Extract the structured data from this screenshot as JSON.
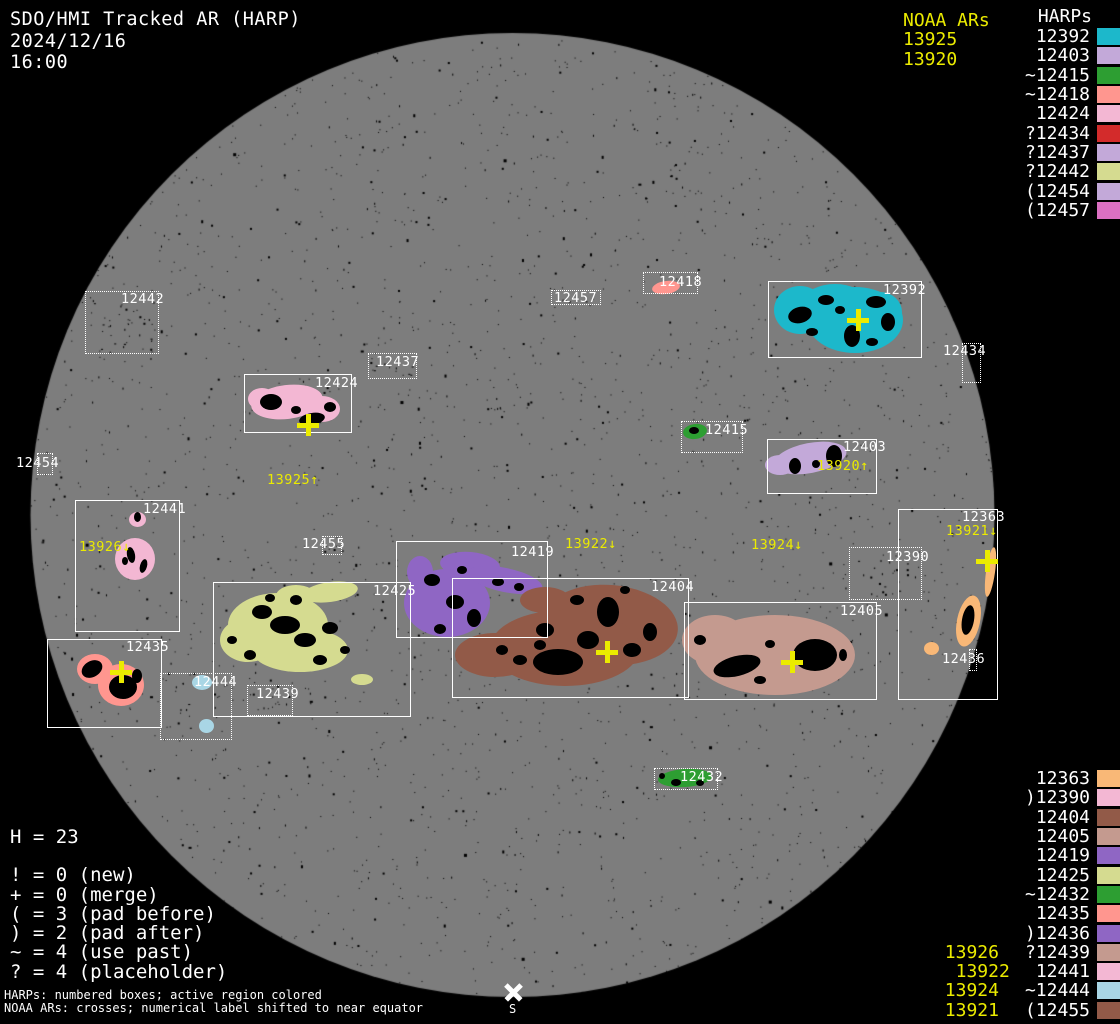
{
  "header": {
    "title": "SDO/HMI Tracked AR (HARP)",
    "date": "2024/12/16",
    "time": "16:00"
  },
  "colors": {
    "background": "#000000",
    "disk": "#7d7d7d",
    "text": "#ffffff",
    "noaa_yellow": "#ebeb00",
    "cyan": "#1cb8cb",
    "lavender": "#c3a9d9",
    "green": "#2d9e32",
    "salmon": "#ff968f",
    "pink": "#f3b7d3",
    "red": "#d32b2b",
    "khaki": "#d5db90",
    "orchid": "#db70c2",
    "orange": "#f9b877",
    "brown": "#925a48",
    "rosy": "#c49a8f",
    "purple": "#8f66c4",
    "lightblue": "#a9d6e5"
  },
  "legend_top_right": {
    "noaa_title": "NOAA ARs",
    "noaa_items": [
      "13925",
      "13920"
    ],
    "harps_title": "HARPs",
    "items": [
      {
        "label": "12392",
        "color": "#1cb8cb"
      },
      {
        "label": "12403",
        "color": "#c3a9d9"
      },
      {
        "label": "~12415",
        "color": "#2d9e32"
      },
      {
        "label": "~12418",
        "color": "#ff968f"
      },
      {
        "label": "12424",
        "color": "#f3b7d3"
      },
      {
        "label": "?12434",
        "color": "#d32b2b"
      },
      {
        "label": "?12437",
        "color": "#c3a9d9"
      },
      {
        "label": "?12442",
        "color": "#d5db90"
      },
      {
        "label": "(12454",
        "color": "#c3a9d9"
      },
      {
        "label": "(12457",
        "color": "#db70c2"
      }
    ]
  },
  "legend_bottom_right": {
    "items": [
      {
        "label": "12363",
        "color": "#f9b877",
        "noaa": ""
      },
      {
        "label": ")12390",
        "color": "#f3b7d3",
        "noaa": ""
      },
      {
        "label": "12404",
        "color": "#925a48",
        "noaa": ""
      },
      {
        "label": "12405",
        "color": "#c49a8f",
        "noaa": ""
      },
      {
        "label": "12419",
        "color": "#8f66c4",
        "noaa": ""
      },
      {
        "label": "12425",
        "color": "#d5db90",
        "noaa": ""
      },
      {
        "label": "~12432",
        "color": "#2d9e32",
        "noaa": ""
      },
      {
        "label": "12435",
        "color": "#ff968f",
        "noaa": ""
      },
      {
        "label": ")12436",
        "color": "#8f66c4",
        "noaa": ""
      },
      {
        "label": "?12439",
        "color": "#c49a8f",
        "noaa": "13926"
      },
      {
        "label": "12441",
        "color": "#f3b7d3",
        "noaa": "13922"
      },
      {
        "label": "~12444",
        "color": "#a9d6e5",
        "noaa": "13924"
      },
      {
        "label": "(12455",
        "color": "#925a48",
        "noaa": "13921"
      }
    ]
  },
  "stats": {
    "h_line": "H = 23",
    "lines": [
      "! = 0 (new)",
      "+ = 0 (merge)",
      "( = 3 (pad before)",
      ") = 2 (pad after)",
      "~ = 4 (use past)",
      "? = 4 (placeholder)"
    ]
  },
  "footer": {
    "line1": "HARPs: numbered boxes; active region colored",
    "line2": "NOAA ARs: crosses; numerical label shifted to near equator"
  },
  "south": {
    "label": "S"
  },
  "noaa_map_labels": [
    {
      "text": "13925↑",
      "xy": [
        267,
        474
      ]
    },
    {
      "text": "13920↑",
      "xy": [
        817,
        460
      ]
    },
    {
      "text": "13926↓",
      "xy": [
        79,
        541
      ]
    },
    {
      "text": "13922↓",
      "xy": [
        565,
        538
      ]
    },
    {
      "text": "13924↓",
      "xy": [
        751,
        539
      ]
    },
    {
      "text": "13921↓",
      "xy": [
        946,
        525
      ]
    }
  ],
  "regions": [
    {
      "id": "12442",
      "label": "12442",
      "box": [
        85,
        291,
        74,
        63
      ],
      "style": "dotted",
      "label_xy": [
        121,
        293
      ],
      "specks": 28
    },
    {
      "id": "12457",
      "label": "12457",
      "box": [
        551,
        290,
        50,
        15
      ],
      "style": "dotted",
      "label_xy": [
        554,
        292
      ],
      "specks": 6
    },
    {
      "id": "12418",
      "label": "12418",
      "box": [
        643,
        272,
        55,
        22
      ],
      "style": "dotted",
      "label_xy": [
        659,
        276
      ],
      "color": "#ff968f",
      "blobs": [
        [
          666,
          287,
          14,
          6.5,
          -8
        ]
      ]
    },
    {
      "id": "12392",
      "label": "12392",
      "box": [
        768,
        281,
        154,
        77
      ],
      "style": "solid",
      "label_xy": [
        883,
        284
      ],
      "color": "#1cb8cb",
      "blobs": [
        [
          800,
          310,
          26,
          24,
          0
        ],
        [
          855,
          320,
          48,
          33,
          0
        ],
        [
          835,
          300,
          30,
          16,
          0
        ],
        [
          880,
          312,
          22,
          20,
          0
        ]
      ],
      "spots": [
        [
          852,
          336,
          8,
          11,
          0
        ],
        [
          800,
          315,
          12,
          8,
          -15
        ],
        [
          826,
          300,
          8,
          5,
          0
        ],
        [
          876,
          302,
          10,
          6,
          0
        ],
        [
          888,
          322,
          7,
          9,
          0
        ],
        [
          812,
          332,
          6,
          4,
          0
        ],
        [
          872,
          342,
          6,
          4,
          0
        ],
        [
          840,
          310,
          5,
          4,
          0
        ]
      ],
      "cross": [
        858,
        320
      ]
    },
    {
      "id": "12434",
      "label": "12434",
      "box": [
        962,
        343,
        19,
        40
      ],
      "style": "dotted",
      "label_xy": [
        943,
        345
      ]
    },
    {
      "id": "12437",
      "label": "12437",
      "box": [
        368,
        353,
        49,
        26
      ],
      "style": "dotted",
      "label_xy": [
        376,
        356
      ],
      "specks": 12
    },
    {
      "id": "12424",
      "label": "12424",
      "box": [
        244,
        374,
        108,
        59
      ],
      "style": "solid",
      "label_xy": [
        315,
        377
      ],
      "color": "#f3b7d3",
      "blobs": [
        [
          287,
          402,
          36,
          17,
          -7
        ],
        [
          322,
          409,
          18,
          13,
          0
        ],
        [
          262,
          399,
          14,
          11,
          0
        ]
      ],
      "spots": [
        [
          271,
          402,
          11,
          8,
          0
        ],
        [
          312,
          419,
          13,
          6,
          -10
        ],
        [
          330,
          407,
          6,
          5,
          0
        ],
        [
          296,
          410,
          5,
          4,
          0
        ]
      ],
      "cross": [
        308,
        425
      ]
    },
    {
      "id": "12415",
      "label": "12415",
      "box": [
        681,
        421,
        62,
        32
      ],
      "style": "dotted",
      "label_xy": [
        705,
        424
      ],
      "color": "#2d9e32",
      "blobs": [
        [
          695,
          431,
          12,
          7.5,
          -8
        ]
      ],
      "spots": [
        [
          694,
          430,
          5,
          3.5,
          0
        ]
      ]
    },
    {
      "id": "12403",
      "label": "12403",
      "box": [
        767,
        439,
        110,
        55
      ],
      "style": "solid",
      "label_xy": [
        843,
        441
      ],
      "color": "#c3a9d9",
      "blobs": [
        [
          810,
          458,
          37,
          15,
          -11
        ],
        [
          780,
          465,
          15,
          10,
          0
        ]
      ],
      "spots": [
        [
          834,
          456,
          8,
          11,
          0
        ],
        [
          795,
          466,
          6,
          8,
          0
        ],
        [
          816,
          464,
          4,
          4,
          0
        ]
      ]
    },
    {
      "id": "12454",
      "label": "12454",
      "box": [
        37,
        453,
        16,
        22
      ],
      "style": "dotted",
      "label_xy": [
        16,
        457
      ]
    },
    {
      "id": "12441",
      "label": "12441",
      "box": [
        75,
        500,
        105,
        132
      ],
      "style": "solid",
      "label_xy": [
        143,
        503
      ],
      "color": "#f3b7d3",
      "blobs": [
        [
          137,
          519,
          8.5,
          7.5,
          0
        ],
        [
          135,
          559,
          20,
          21,
          0
        ]
      ],
      "spots": [
        [
          137,
          517,
          3.5,
          5,
          0
        ],
        [
          131,
          555,
          4,
          8,
          -10
        ],
        [
          143,
          566,
          3.5,
          7,
          15
        ],
        [
          125,
          561,
          3,
          4,
          0
        ]
      ]
    },
    {
      "id": "12455",
      "label": "12455",
      "box": [
        322,
        536,
        20,
        19
      ],
      "style": "dotted",
      "label_xy": [
        302,
        538
      ],
      "specks": 5
    },
    {
      "id": "12419",
      "label": "12419",
      "box": [
        396,
        541,
        152,
        97
      ],
      "style": "solid",
      "label_xy": [
        511,
        546
      ],
      "color": "#8f66c4",
      "blobs": [
        [
          470,
          565,
          30,
          13,
          5
        ],
        [
          447,
          603,
          43,
          34,
          0
        ],
        [
          505,
          580,
          38,
          12,
          12
        ],
        [
          420,
          572,
          13,
          16,
          0
        ]
      ],
      "spots": [
        [
          432,
          580,
          8,
          6,
          0
        ],
        [
          455,
          602,
          9,
          7,
          0
        ],
        [
          474,
          618,
          7,
          9,
          0
        ],
        [
          440,
          629,
          6,
          5,
          0
        ],
        [
          498,
          582,
          6,
          4,
          0
        ],
        [
          519,
          587,
          5,
          4,
          0
        ],
        [
          462,
          570,
          5,
          4,
          0
        ]
      ]
    },
    {
      "id": "12390",
      "label": "12390",
      "box": [
        849,
        547,
        73,
        53
      ],
      "style": "dotted",
      "label_xy": [
        886,
        551
      ],
      "specks": 20
    },
    {
      "id": "12363",
      "label": "12363",
      "box": [
        898,
        509,
        100,
        191
      ],
      "style": "solid",
      "label_xy": [
        962,
        511
      ],
      "color": "#f9b877",
      "blobs": [
        [
          990,
          572,
          4.5,
          25,
          8
        ],
        [
          968,
          621,
          11.5,
          26,
          12
        ],
        [
          931,
          648,
          7.5,
          6.5,
          0
        ]
      ],
      "spots": [
        [
          968,
          620,
          6,
          15,
          10
        ]
      ],
      "cross": [
        987,
        561
      ]
    },
    {
      "id": "12425",
      "label": "12425",
      "box": [
        213,
        582,
        198,
        135
      ],
      "style": "solid",
      "label_xy": [
        373,
        585
      ],
      "color": "#d5db90",
      "blobs": [
        [
          330,
          592,
          28,
          10,
          -8
        ],
        [
          278,
          625,
          50,
          32,
          0
        ],
        [
          300,
          650,
          48,
          22,
          0
        ],
        [
          248,
          640,
          28,
          22,
          0
        ],
        [
          362,
          679,
          11,
          5.5,
          0
        ],
        [
          296,
          596,
          20,
          11,
          0
        ]
      ],
      "spots": [
        [
          262,
          612,
          10,
          7,
          0
        ],
        [
          285,
          625,
          15,
          9,
          0
        ],
        [
          305,
          640,
          11,
          7,
          0
        ],
        [
          250,
          655,
          6,
          5,
          0
        ],
        [
          330,
          628,
          8,
          6,
          0
        ],
        [
          296,
          600,
          6,
          5,
          0
        ],
        [
          320,
          660,
          7,
          5,
          0
        ],
        [
          345,
          650,
          5,
          4,
          0
        ],
        [
          232,
          640,
          5,
          4,
          0
        ],
        [
          270,
          598,
          5,
          4,
          0
        ]
      ]
    },
    {
      "id": "12439",
      "label": "12439",
      "box": [
        247,
        685,
        46,
        31
      ],
      "style": "dotted",
      "label_xy": [
        256,
        688
      ],
      "specks": 10
    },
    {
      "id": "12444",
      "label": "12444",
      "box": [
        160,
        673,
        72,
        67
      ],
      "style": "dotted",
      "label_xy": [
        194,
        676
      ],
      "color": "#a9d6e5",
      "blobs": [
        [
          202,
          682,
          10,
          7.5,
          0
        ],
        [
          206,
          726,
          7.5,
          7,
          0
        ]
      ],
      "specks": 12
    },
    {
      "id": "12404",
      "label": "12404",
      "box": [
        452,
        578,
        237,
        120
      ],
      "style": "solid",
      "label_xy": [
        651,
        581
      ],
      "color": "#925a48",
      "blobs": [
        [
          610,
          625,
          68,
          40,
          5
        ],
        [
          565,
          648,
          75,
          38,
          0
        ],
        [
          495,
          655,
          40,
          22,
          0
        ],
        [
          545,
          600,
          25,
          13,
          0
        ]
      ],
      "spots": [
        [
          558,
          662,
          25,
          13,
          0
        ],
        [
          588,
          640,
          11,
          9,
          0
        ],
        [
          545,
          630,
          9,
          7,
          0
        ],
        [
          608,
          612,
          11,
          15,
          0
        ],
        [
          632,
          650,
          9,
          7,
          0
        ],
        [
          520,
          660,
          7,
          5,
          0
        ],
        [
          577,
          600,
          7,
          5,
          0
        ],
        [
          650,
          632,
          7,
          9,
          0
        ],
        [
          502,
          650,
          6,
          5,
          0
        ],
        [
          540,
          645,
          6,
          5,
          0
        ],
        [
          625,
          590,
          5,
          4,
          0
        ]
      ],
      "cross": [
        607,
        652
      ]
    },
    {
      "id": "12405",
      "label": "12405",
      "box": [
        684,
        602,
        193,
        98
      ],
      "style": "solid",
      "label_xy": [
        840,
        605
      ],
      "color": "#c49a8f",
      "blobs": [
        [
          775,
          655,
          80,
          40,
          0
        ],
        [
          715,
          640,
          33,
          25,
          0
        ]
      ],
      "spots": [
        [
          737,
          666,
          24,
          10,
          -14
        ],
        [
          815,
          655,
          22,
          16,
          0
        ],
        [
          700,
          640,
          6,
          5,
          0
        ],
        [
          770,
          644,
          5,
          4,
          0
        ],
        [
          843,
          655,
          4,
          6,
          0
        ],
        [
          760,
          680,
          6,
          4,
          0
        ]
      ],
      "cross": [
        792,
        662
      ]
    },
    {
      "id": "12435",
      "label": "12435",
      "box": [
        47,
        639,
        115,
        89
      ],
      "style": "solid",
      "label_xy": [
        126,
        641
      ],
      "color": "#ff968f",
      "blobs": [
        [
          95,
          669,
          18,
          15,
          0
        ],
        [
          121,
          685,
          23,
          21,
          0
        ]
      ],
      "spots": [
        [
          92,
          669,
          11,
          8,
          -30
        ],
        [
          123,
          687,
          14,
          12,
          0
        ],
        [
          137,
          676,
          5,
          7,
          0
        ]
      ],
      "cross": [
        121,
        672
      ]
    },
    {
      "id": "12436",
      "label": "12436",
      "box": [
        969,
        649,
        8,
        22
      ],
      "style": "dotted",
      "label_xy": [
        942,
        653
      ]
    },
    {
      "id": "12432",
      "label": "12432",
      "box": [
        654,
        768,
        64,
        22
      ],
      "style": "dotted",
      "label_xy": [
        680,
        771
      ],
      "color": "#2d9e32",
      "blobs": [
        [
          685,
          778,
          27,
          9,
          -4
        ]
      ],
      "spots": [
        [
          676,
          782,
          5,
          3.5,
          0
        ],
        [
          700,
          783,
          4,
          3,
          0
        ],
        [
          662,
          776,
          3,
          3,
          0
        ]
      ]
    }
  ]
}
